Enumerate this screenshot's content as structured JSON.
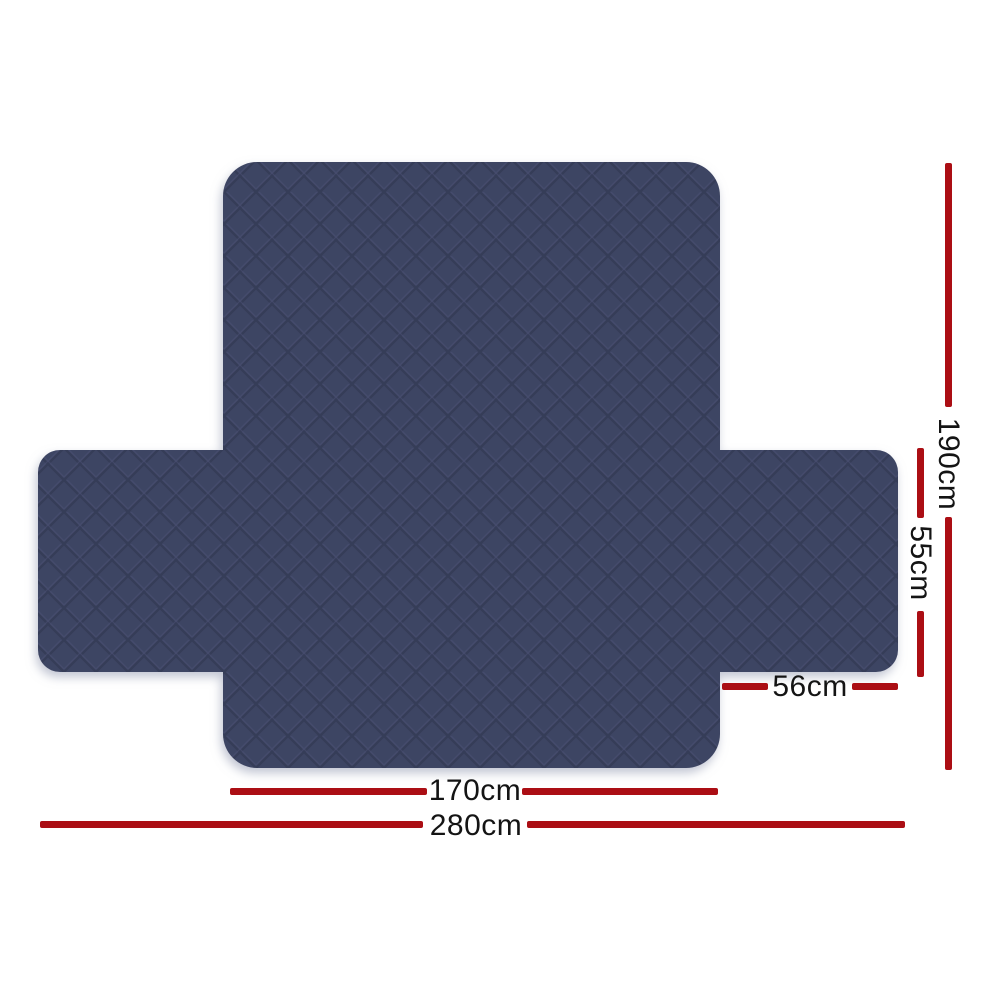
{
  "product_diagram": {
    "description": "quilted sofa cover with measurement lines",
    "colors": {
      "background": "#ffffff",
      "fabric_navy": "#3e4564",
      "quilt_seam": "#353b57",
      "quilt_highlight": "#4a5274",
      "dimension_line_red": "#ab0e14",
      "label_text": "#141414"
    },
    "dimensions": {
      "cover_height": "190cm",
      "side_flap_height": "55cm",
      "side_flap_width": "56cm",
      "seat_width": "170cm",
      "total_width": "280cm"
    }
  }
}
